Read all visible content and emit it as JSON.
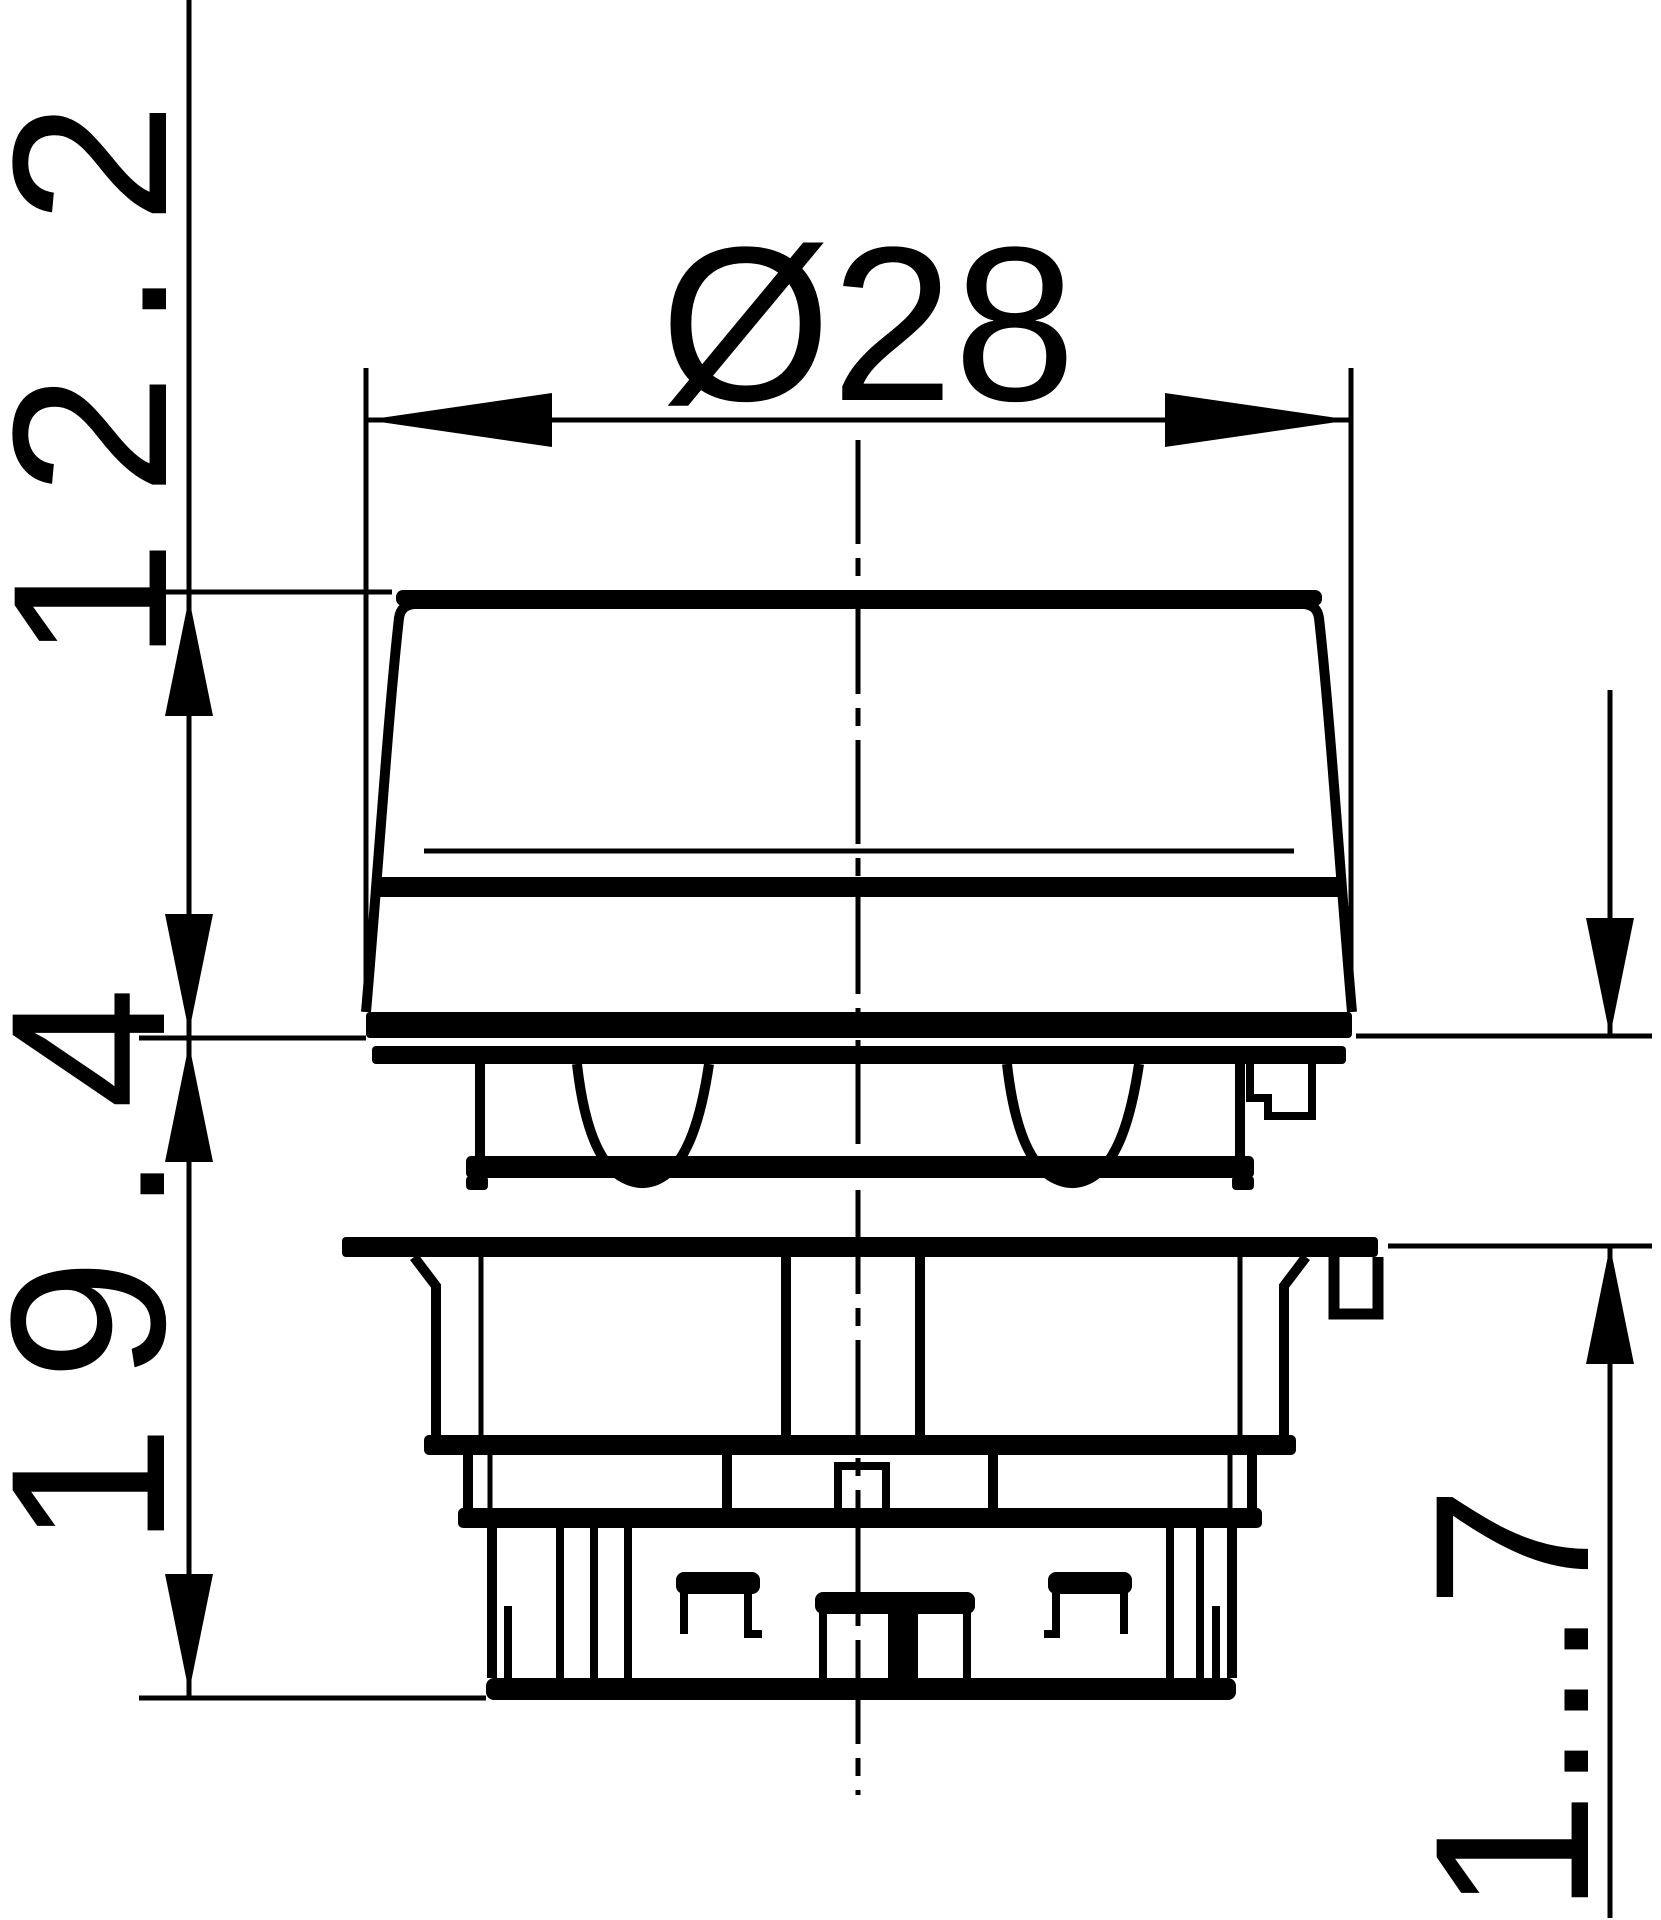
{
  "page": {
    "type": "technical-dimension-drawing",
    "background_color": "#ffffff",
    "line_color": "#000000"
  },
  "labels": {
    "cap_height": "12.2",
    "diameter": "Ø28",
    "body_height": "19.4",
    "panel_thickness": "1...7"
  }
}
